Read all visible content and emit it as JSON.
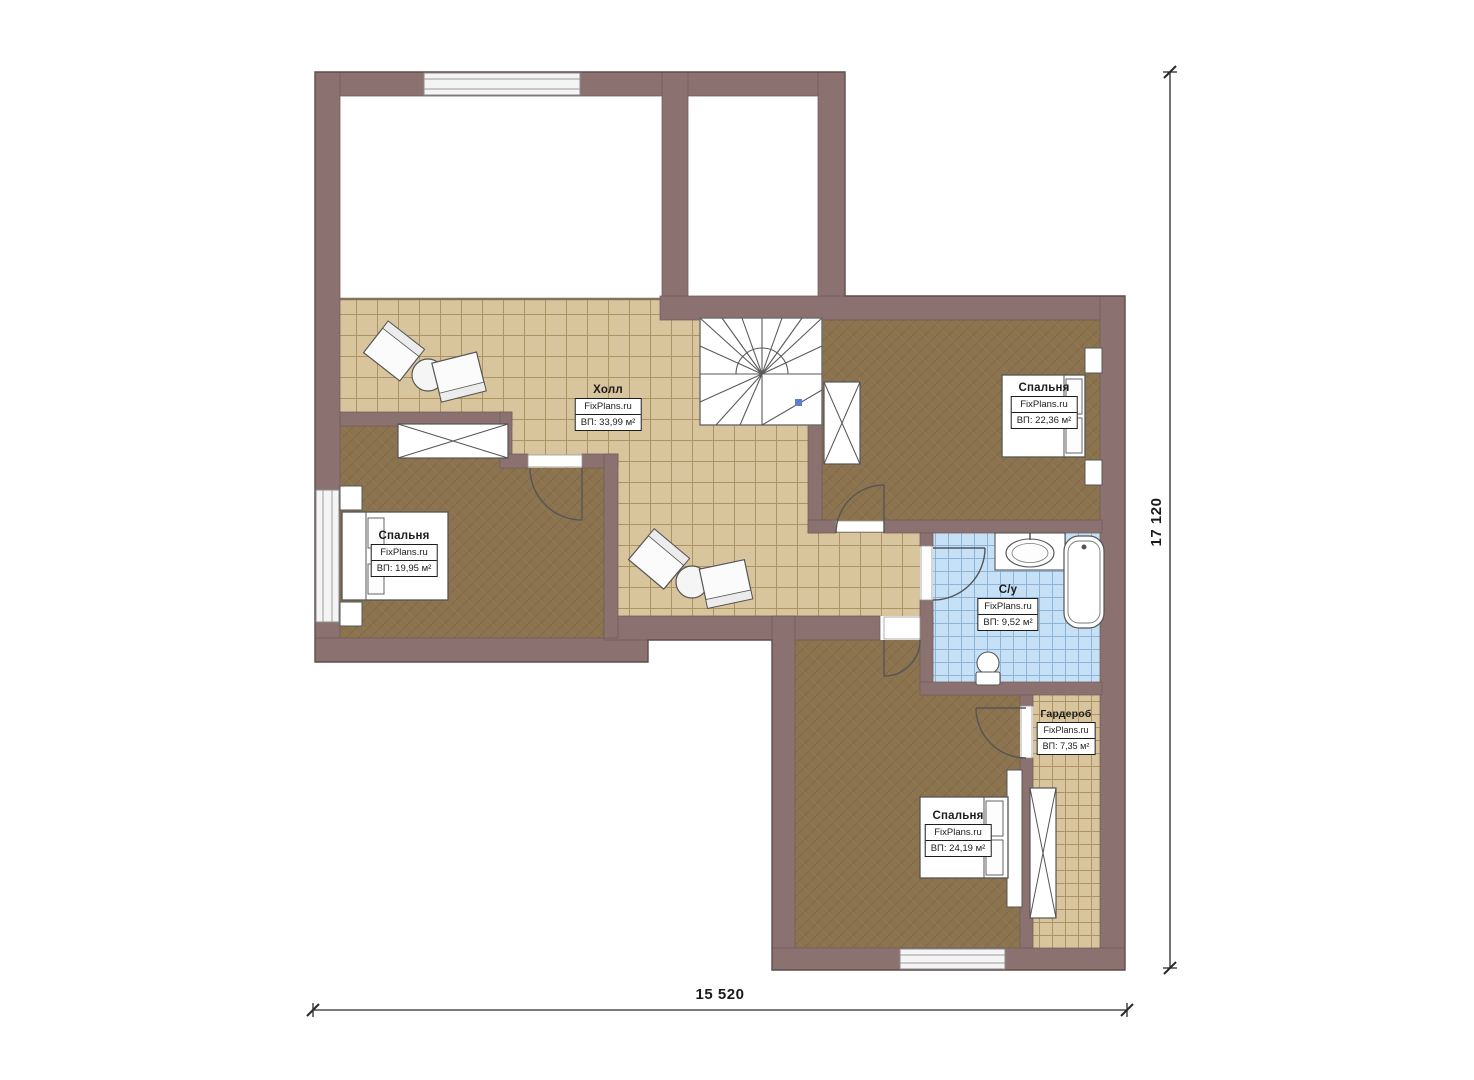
{
  "brand": "FixPlans.ru",
  "rooms": {
    "hall": {
      "name": "Холл",
      "area": "ВП: 33,99 м²"
    },
    "bedroom_left": {
      "name": "Спальня",
      "area": "ВП: 19,95 м²"
    },
    "bedroom_top_right": {
      "name": "Спальня",
      "area": "ВП: 22,36 м²"
    },
    "bathroom": {
      "name": "С/у",
      "area": "ВП: 9,52 м²"
    },
    "wardrobe": {
      "name": "Гардероб",
      "area": "ВП: 7,35 м²"
    },
    "bedroom_bottom": {
      "name": "Спальня",
      "area": "ВП: 24,19 м²"
    }
  },
  "dimensions": {
    "width_label": "15 520",
    "height_label": "17 120"
  },
  "colors": {
    "wall": "#8b7271",
    "hall_tile": "#d9c59d",
    "bedroom_floor": "#8c734f",
    "bath_tile": "#c6e1f6",
    "furniture_outline": "#555555",
    "stair_marker": "#5b7fd0"
  }
}
